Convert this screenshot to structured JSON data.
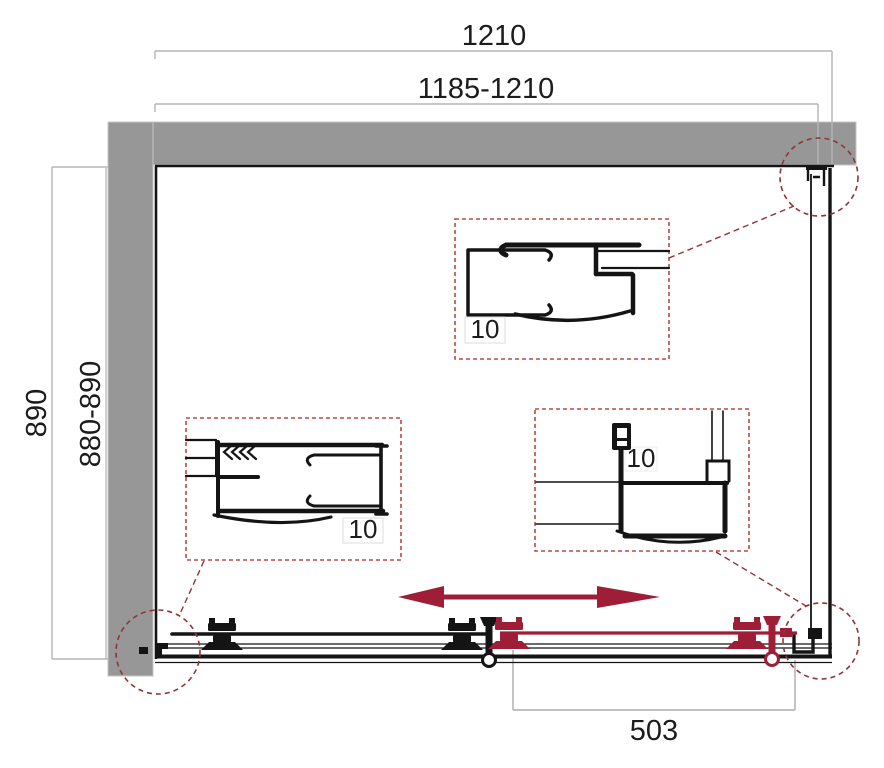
{
  "drawing": {
    "title": "Sliding shower enclosure - plan view technical drawing",
    "dimensions": {
      "top_overall": "1210",
      "top_range": "1185-1210",
      "side_overall": "890",
      "side_range": "880-890",
      "door_travel": "503"
    },
    "details": [
      {
        "name": "wall-profile-detail-top",
        "label": "10"
      },
      {
        "name": "wall-profile-detail-left",
        "label": "10"
      },
      {
        "name": "support-profile-detail-right",
        "label": "10"
      }
    ],
    "colors": {
      "accent_red": "#9e1e38",
      "detail_box_red": "#bb4a44",
      "callout_circle_red": "#8f3439",
      "wall_gray": "#979797",
      "dimension_line_gray": "#b5b5b5",
      "drawing_black": "#141414"
    }
  }
}
